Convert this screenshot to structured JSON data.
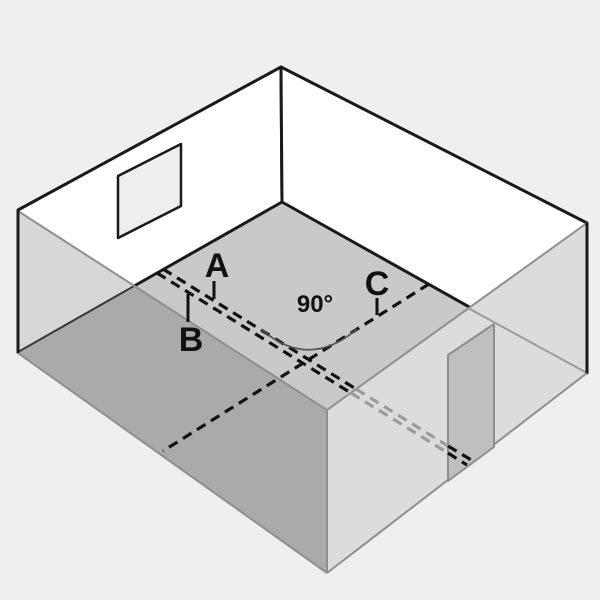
{
  "figure": {
    "labels": {
      "line_a": "A",
      "line_b": "B",
      "line_c": "C",
      "angle": "90°"
    },
    "colors": {
      "background": "#efefef",
      "wall_white": "#ffffff",
      "floor": "#c9c9c9",
      "front_left_wall": "#aaaaaa",
      "front_left_wall_over_white": "#d7d7d7",
      "front_right_wall": "#dcdcdc",
      "door": "#bfbfbf",
      "window": "#eeeeee",
      "outline": "#1a1a1a",
      "soft_edge": "#8f8f8f",
      "seen_through_edge": "#9b9b9b",
      "dash_black": "#111111",
      "dash_dimmed": "#9b9b9b",
      "arc": "#555555"
    }
  }
}
